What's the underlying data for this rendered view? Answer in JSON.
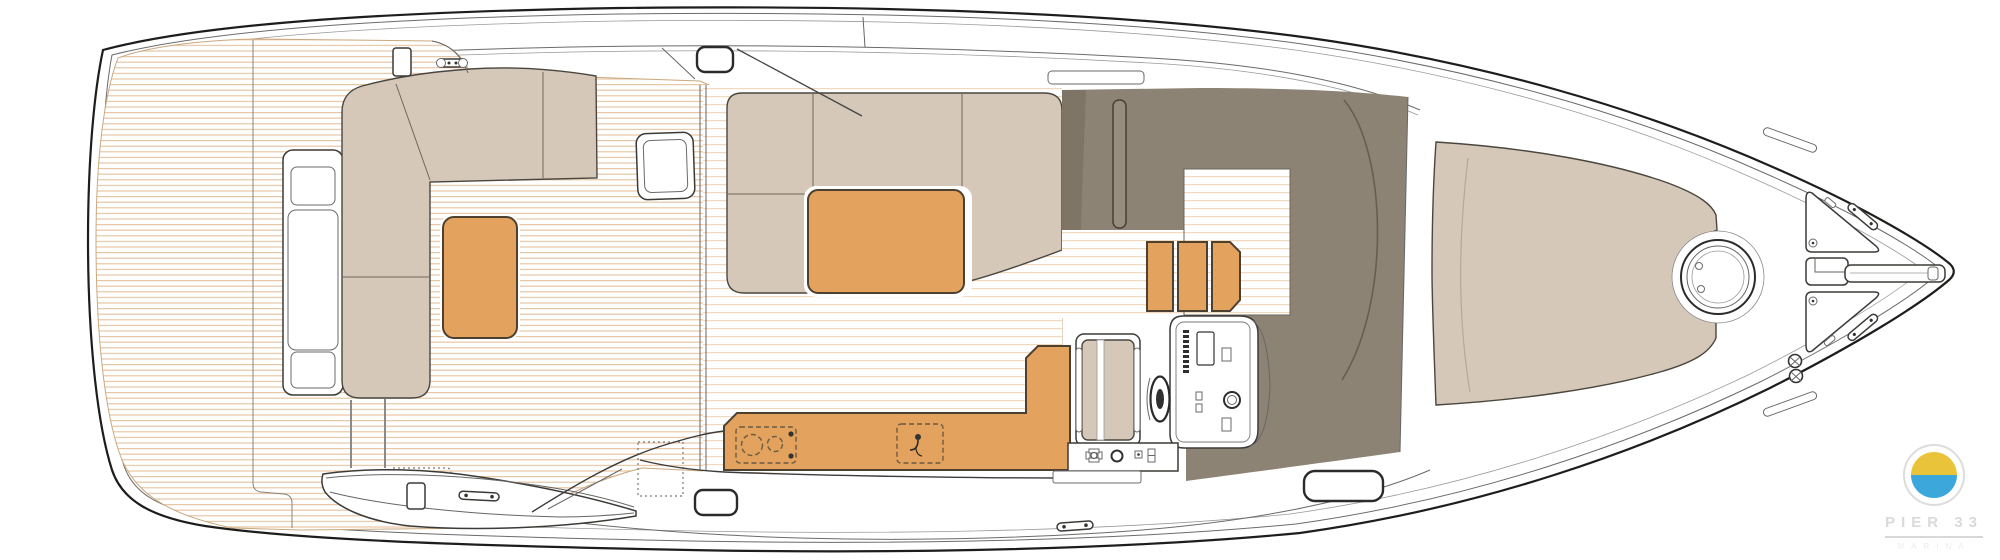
{
  "palette": {
    "pageBg": "#ffffff",
    "hullLine": "#1d1d1b",
    "hullLineSoft": "#6b6b6b",
    "teakLine": "#e4c29c",
    "teakLineLight": "#efd7b8",
    "teakEdge": "#caa87e",
    "upholstery": "#d5c8b8",
    "upholsteryShade": "#7e7567",
    "wood": "#e3a35f",
    "woodEdge": "#4c4030",
    "coaming": "#8d8375",
    "logoYellow": "#e9c43b",
    "logoBlue": "#3ba7db",
    "logoGray": "#dcdcdc"
  },
  "logo": {
    "brand": "PIER 33",
    "subtitle": "MARINA"
  },
  "plan": {
    "view": "motor-yacht-main-deck-top-view",
    "areas": [
      "swim-platform",
      "cockpit",
      "salon",
      "galley",
      "helm-station",
      "companionway",
      "foredeck-sunpad",
      "bow-anchor-area",
      "side-decks"
    ],
    "features": [
      "transom-seat-module",
      "cockpit-l-sofa",
      "cockpit-table",
      "boarding-stairs",
      "salon-l-sofa",
      "coffee-table",
      "galley-counter",
      "galley-stove",
      "galley-sink",
      "steering-wheel",
      "helm-console",
      "helm-seat",
      "companionway-steps",
      "sun-pad",
      "round-deck-hatch",
      "anchor-windlass",
      "anchor-channel",
      "bow-locker-hatches",
      "bow-cleats",
      "mooring-vents",
      "deck-cleats",
      "deck-windows"
    ],
    "details": {
      "companionway_step_count": 3,
      "stove_burner_count": 2,
      "bow_locker_count": 2,
      "mooring_vent_count": 2
    }
  }
}
